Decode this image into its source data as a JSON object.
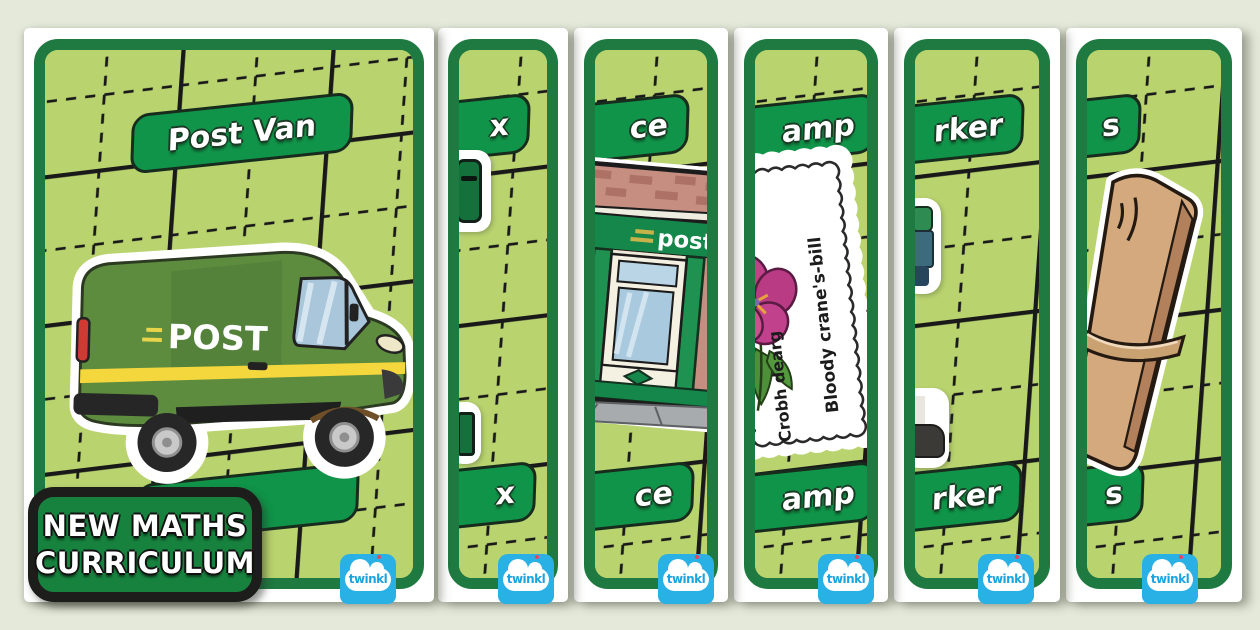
{
  "page": {
    "background": "#e5e9da"
  },
  "badge": {
    "line1": "NEW MATHS",
    "line2": "CURRICULUM"
  },
  "logo": {
    "text": "twinkl"
  },
  "colors": {
    "frame_green": "#1e7a40",
    "interior_green": "#b9d36f",
    "pill_green": "#109449",
    "grid_line": "#191919",
    "badge_green": "#17823e",
    "twinkl_blue": "#29b1e6",
    "van_green": "#5d8c3f",
    "stamp_flower": "#c2418c",
    "parcel_tan": "#d4a97e"
  },
  "cards": [
    {
      "name": "post-van",
      "top_label": "Post Van",
      "bottom_label": "",
      "sticker": "post-van-illustration",
      "sticker_text": "POST"
    },
    {
      "name": "post-box",
      "top_label": "x",
      "bottom_label": "x",
      "sticker": "post-box-edge"
    },
    {
      "name": "post-office",
      "top_label": "ce",
      "bottom_label": "ce",
      "sticker": "post-office-shopfront",
      "sticker_text": "post"
    },
    {
      "name": "stamp",
      "top_label": "amp",
      "bottom_label": "amp",
      "sticker": "flower-stamp",
      "stamp_text_1": "Bloody crane's-bill",
      "stamp_text_2": "Crobh dearg"
    },
    {
      "name": "postal-worker",
      "top_label": "rker",
      "bottom_label": "rker",
      "sticker": "postal-worker-edge"
    },
    {
      "name": "letters",
      "top_label": "s",
      "bottom_label": "s",
      "sticker": "letter-bundle"
    }
  ]
}
